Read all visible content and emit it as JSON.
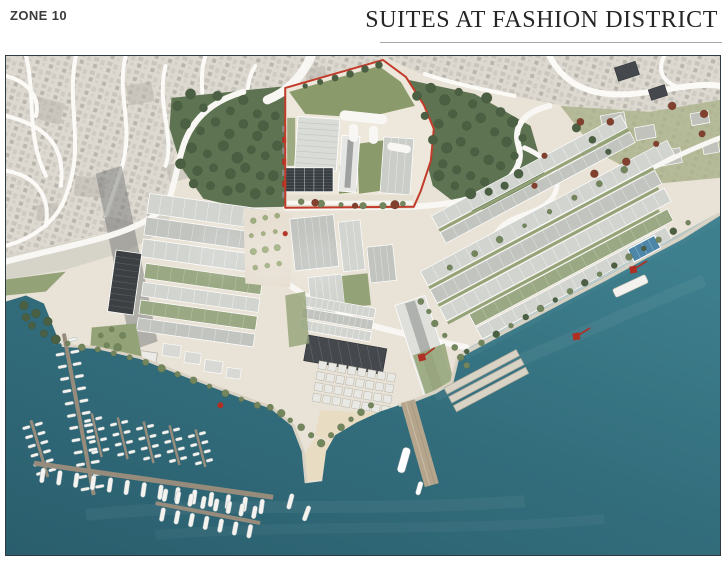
{
  "header": {
    "zone_label": "ZONE 10",
    "title": "SUITES AT FASHION DISTRICT"
  },
  "map": {
    "type": "architectural-masterplan-aerial-rendering",
    "highlighted_parcel": {
      "outline_color": "#c23b2a"
    },
    "colors": {
      "sea": "#35707f",
      "sea-deep": "#2a5e6d",
      "land": "#e9e3d7",
      "sketch": "#dcd9d1",
      "forest": "#5e7351",
      "lawn": "#94a377",
      "roof-light": "#d2d4d0",
      "roof-mid": "#c2c4c0",
      "roof-dark": "#45494d",
      "roof-green": "#9aa883",
      "road": "#f8f7f3",
      "pier": "#978c7c",
      "boat": "#f4f3ef",
      "sand": "#e8dcc2",
      "pool": "#4d86a8",
      "crane": "#b02f23",
      "outline-red": "#c23b2a",
      "tree-dark": "#4b5f43",
      "tree-mid": "#73855c",
      "tree-red": "#82402e",
      "frame": "#2e3b41"
    }
  }
}
